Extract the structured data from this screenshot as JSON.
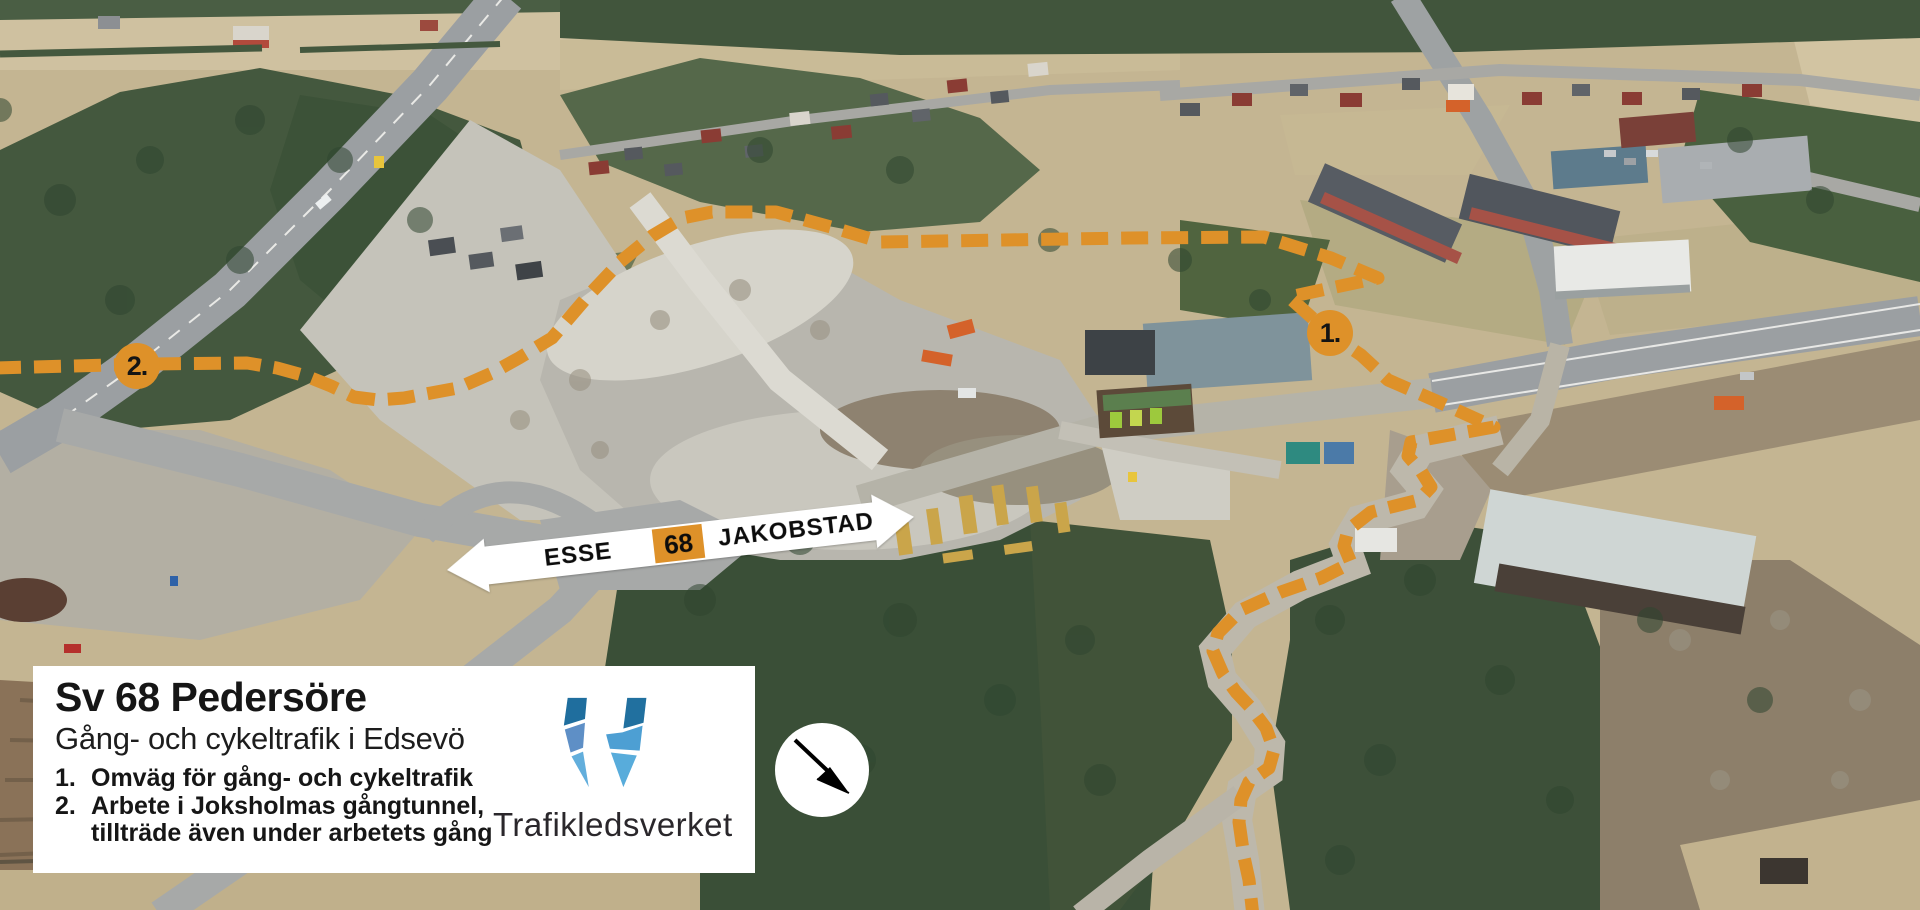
{
  "overlay": {
    "info_box": {
      "title": "Sv 68 Pedersöre",
      "subtitle": "Gång- och cykeltrafik i Edsevö",
      "list": [
        {
          "num": "1.",
          "line1": "Omväg för gång- och cykeltrafik",
          "line2": ""
        },
        {
          "num": "2.",
          "line1": "Arbete i Joksholmas gångtunnel,",
          "line2": "tillträde även under arbetets gång"
        }
      ],
      "agency": "Trafikledsverket"
    },
    "road_sign": {
      "left_destination": "ESSE",
      "route_number": "68",
      "right_destination": "JAKOBSTAD"
    },
    "markers": [
      {
        "label": "1."
      },
      {
        "label": "2."
      }
    ],
    "colors": {
      "route_orange": "#DE9129",
      "sign_plate_white": "#FFFFFF",
      "sign_text_black": "#0C0C0C",
      "logo_blues": [
        "#1F6E9E",
        "#5E8FC6",
        "#62AEDC",
        "#21709F",
        "#4D9FD3",
        "#58ACDB"
      ]
    },
    "icons": [
      "north-arrow-icon",
      "trafikledsverket-w-logo",
      "route-detour-dashed-line",
      "direction-sign-arrows"
    ]
  }
}
